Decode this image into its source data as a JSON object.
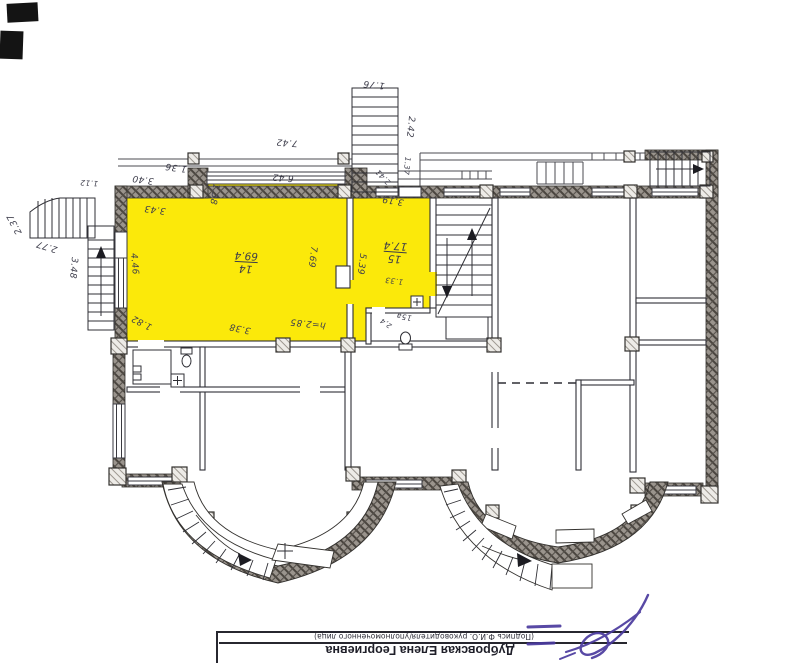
{
  "plan": {
    "highlight_color": "#fbe90a",
    "wall_color": "#9a948d",
    "dims": [
      "2.37",
      "2.77",
      "3.48",
      "1.12",
      "3.40",
      "1.36",
      "7.42",
      "1.38",
      "3.43",
      "6.42",
      "4.46",
      "1.82",
      "3.38",
      "h=2.85",
      "7.69",
      "5.39",
      "3.19",
      "1.33",
      "1.76",
      "2.42",
      "2.41",
      "1.37"
    ],
    "rooms": [
      {
        "number": "14",
        "area": "69.4"
      },
      {
        "number": "15",
        "area": "17.4"
      },
      {
        "number": "15а",
        "area": "2,4"
      }
    ],
    "icons": [
      "toilet-icon",
      "sink-cross-icon",
      "stair-direction-arrow-icon",
      "survey-cross-icon"
    ]
  },
  "footer": {
    "name": "Дубровская Елена Георгиевна",
    "caption": "(Подпись Ф.И.О. руководителя/уполномоченного лица)",
    "signature_ink_color": "#4a3a9e"
  }
}
